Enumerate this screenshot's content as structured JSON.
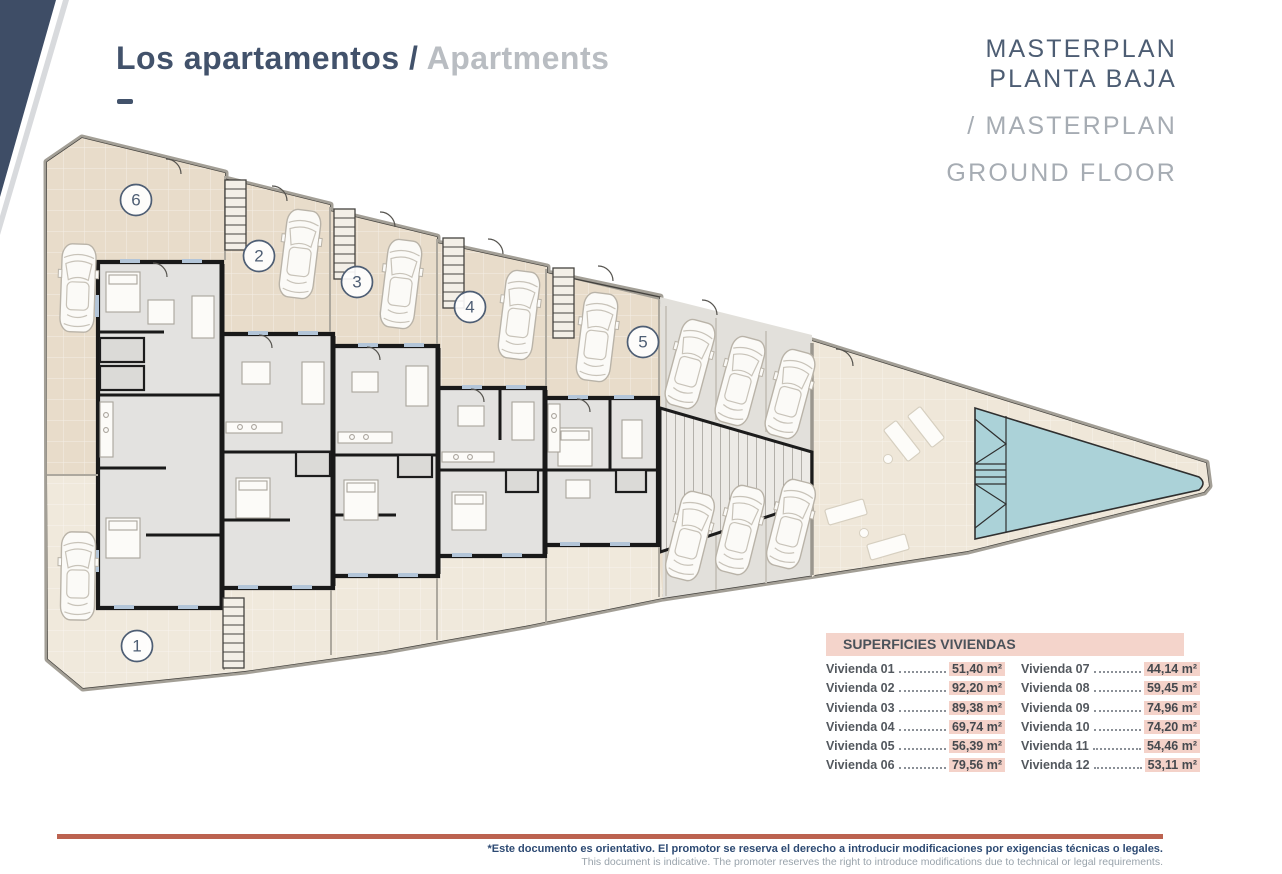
{
  "header": {
    "title_primary": "Los apartamentos /",
    "title_secondary": "Apartments",
    "plan_title_es_line1": "MASTERPLAN",
    "plan_title_es_line2": "PLANTA BAJA",
    "plan_title_en_line1": "/ MASTERPLAN",
    "plan_title_en_line2": "GROUND FLOOR"
  },
  "plan": {
    "units": [
      {
        "label": "6"
      },
      {
        "label": "2"
      },
      {
        "label": "3"
      },
      {
        "label": "4"
      },
      {
        "label": "5"
      },
      {
        "label": "1"
      }
    ]
  },
  "table": {
    "title": "SUPERFICIES VIVIENDAS",
    "left": [
      {
        "label": "Vivienda 01",
        "value": "51,40 m²"
      },
      {
        "label": "Vivienda 02",
        "value": "92,20 m²"
      },
      {
        "label": "Vivienda 03",
        "value": "89,38 m²"
      },
      {
        "label": "Vivienda 04",
        "value": "69,74 m²"
      },
      {
        "label": "Vivienda 05",
        "value": "56,39 m²"
      },
      {
        "label": "Vivienda 06",
        "value": "79,56 m²"
      }
    ],
    "right": [
      {
        "label": "Vivienda 07",
        "value": "44,14 m²"
      },
      {
        "label": "Vivienda 08",
        "value": "59,45 m²"
      },
      {
        "label": "Vivienda 09",
        "value": "74,96 m²"
      },
      {
        "label": "Vivienda 10",
        "value": "74,20 m²"
      },
      {
        "label": "Vivienda 11",
        "value": "54,46 m²"
      },
      {
        "label": "Vivienda 12",
        "value": "53,11 m²"
      }
    ]
  },
  "footer": {
    "disclaimer_es": "*Este documento es orientativo. El promotor se reserva el derecho a introducir modificaciones por exigencias técnicas o legales.",
    "disclaimer_en": "This document is indicative. The promoter reserves the right to introduce modifications due to technical or legal requirements."
  },
  "colors": {
    "navy_corner": "#3e4d66",
    "title_slate": "#42526b",
    "title_gray": "#b9bdc2",
    "accent_line": "#bc6350",
    "table_highlight": "#f4d2c9",
    "pool": "#abd2d8",
    "terrace": "#e8dcca",
    "apartment_floor": "#e3e2e0"
  }
}
